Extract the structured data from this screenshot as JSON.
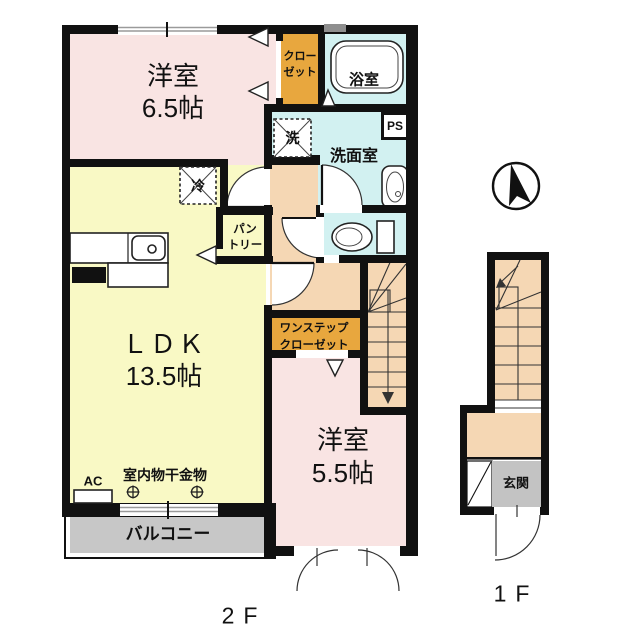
{
  "floor_plan": {
    "rooms": {
      "bedroom_65": {
        "name": "洋室",
        "size": "6.5帖"
      },
      "closet": {
        "line1": "クロー",
        "line2": "ゼット"
      },
      "bathroom": {
        "name": "浴室"
      },
      "washroom": {
        "name": "洗面室"
      },
      "ldk": {
        "name": "ＬＤＫ",
        "size": "13.5帖"
      },
      "pantry": {
        "line1": "パン",
        "line2": "トリー"
      },
      "one_step_closet": {
        "line1": "ワンステップ",
        "line2": "クローゼット"
      },
      "bedroom_55": {
        "name": "洋室",
        "size": "5.5帖"
      },
      "balcony": {
        "name": "バルコニー"
      },
      "entrance": {
        "name": "玄関"
      }
    },
    "labels": {
      "washer": "洗",
      "fridge": "冷",
      "pipe_space": "PS",
      "air_con": "AC",
      "indoor_laundry_hook": "室内物干金物",
      "floor_2": "2F",
      "floor_1": "1F"
    },
    "colors": {
      "wall": "#111111",
      "bedroom_pink": "#f9e4e3",
      "ldk_yellow": "#f9f9c5",
      "water_cyan": "#d2f1f1",
      "closet_orange": "#e8a73e",
      "hallway_peach": "#f5d7b4",
      "balcony_gray": "#c7c7c7",
      "entrance_gray": "#c3c3c3"
    }
  }
}
